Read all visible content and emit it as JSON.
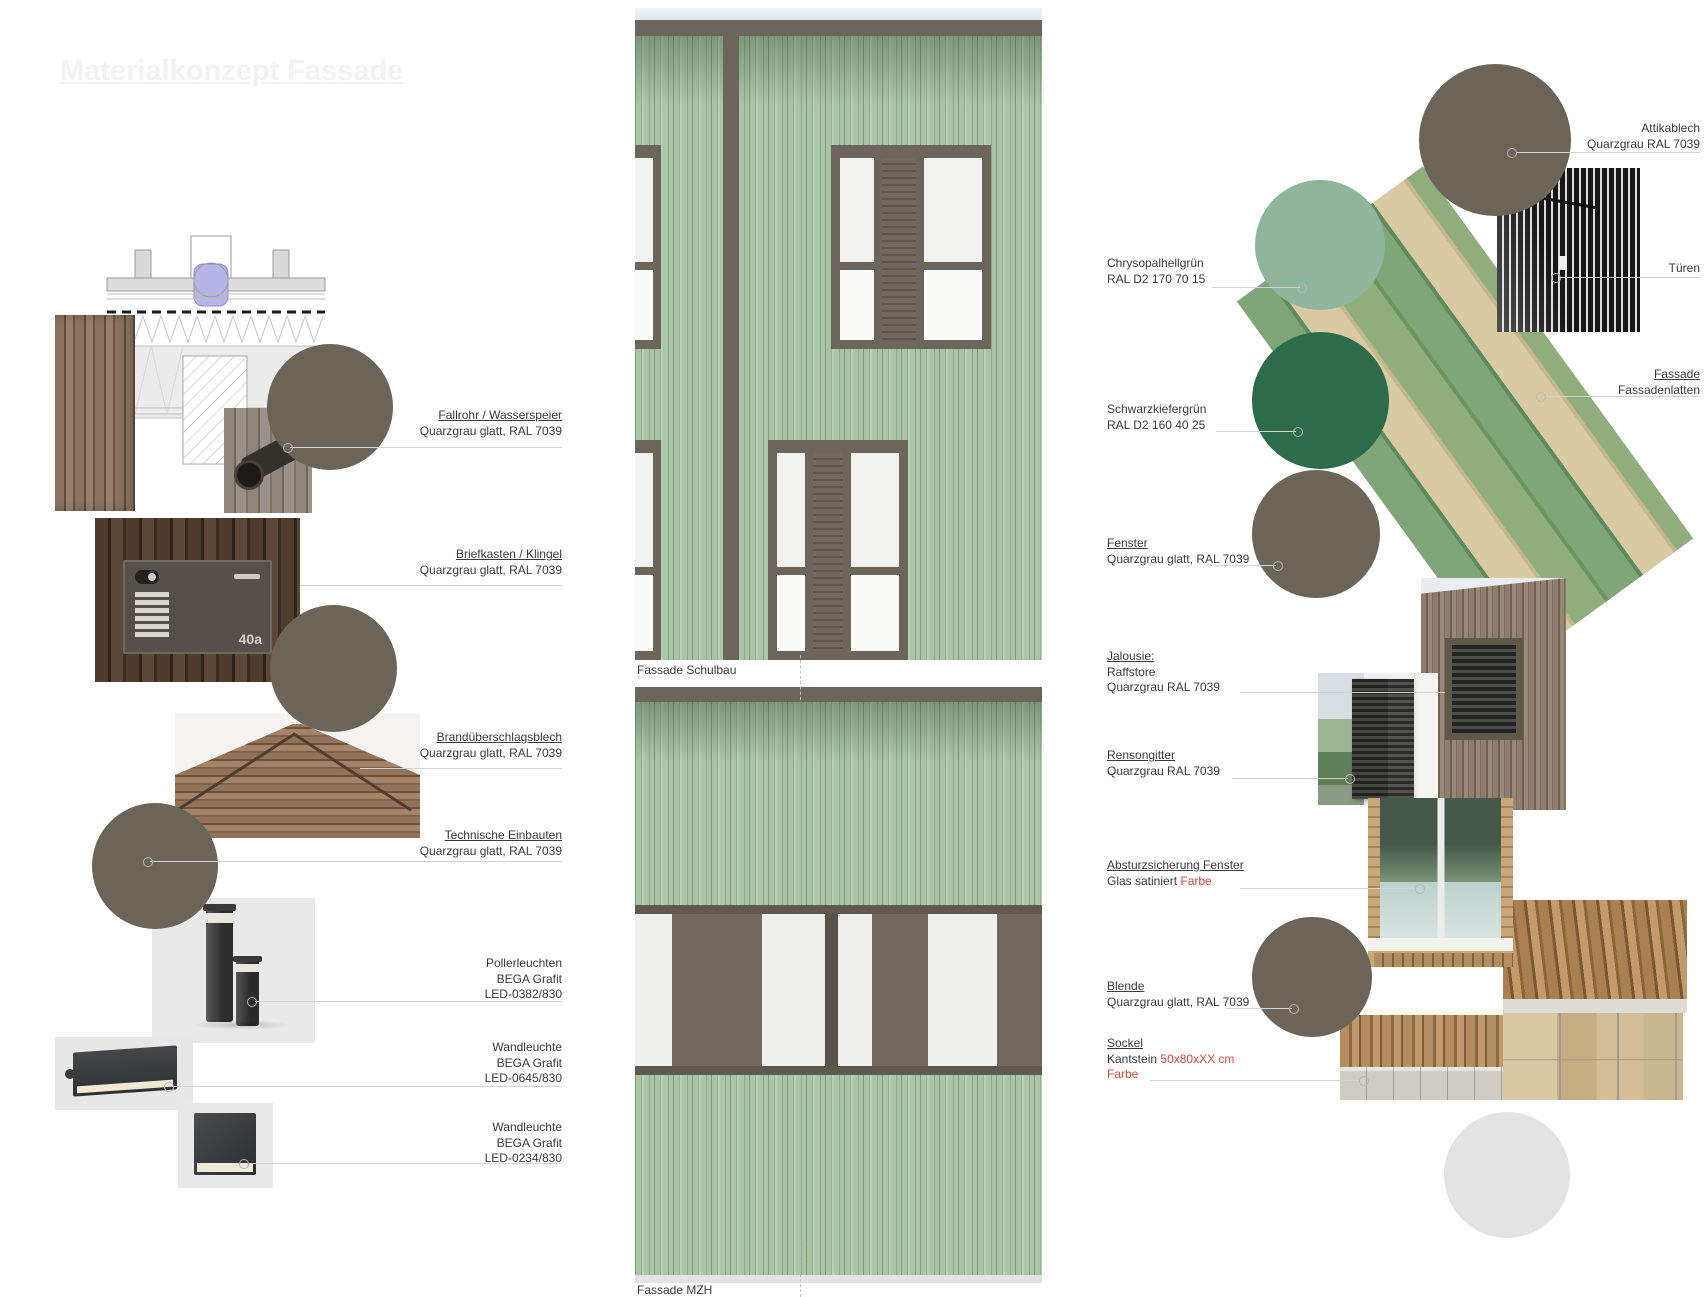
{
  "title": "Materialkonzept Fassade",
  "captions": {
    "schulbau": "Fassade Schulbau",
    "mzh": "Fassade MZH"
  },
  "mailbox_number": "40a",
  "colors": {
    "quarzgrau": "#6B6459",
    "chrysopalhellgruen": "#8FB59D",
    "schwarzkiefergruen": "#2E6B4B",
    "sockel_hell": "#E3E3E3",
    "fassade_gruen": "#A9C5A5",
    "rahmen_grau": "#6B655C",
    "akzent_rot": "#D8463C"
  },
  "left": {
    "labels": [
      {
        "title": "Fallrohr / Wasserspeier",
        "sub1": "Quarzgrau glatt, RAL 7039"
      },
      {
        "title": "Briefkasten / Klingel",
        "sub1": "Quarzgrau glatt, RAL 7039"
      },
      {
        "title": "Brandüberschlagsblech",
        "sub1": "Quarzgrau glatt, RAL 7039"
      },
      {
        "title": "Technische Einbauten",
        "sub1": "Quarzgrau glatt, RAL 7039"
      },
      {
        "title": "Pollerleuchten",
        "sub1": "BEGA Grafit",
        "sub2": "LED-0382/830"
      },
      {
        "title": "Wandleuchte",
        "sub1": "BEGA Grafit",
        "sub2": "LED-0645/830"
      },
      {
        "title": "Wandleuchte",
        "sub1": "BEGA Grafit",
        "sub2": "LED-0234/830"
      }
    ]
  },
  "right": {
    "labels_left": [
      {
        "title": "Chrysopalhellgrün",
        "sub1": "RAL D2 170 70 15"
      },
      {
        "title": "Schwarzkiefergrün",
        "sub1": "RAL D2 160 40 25"
      },
      {
        "title": "Fenster",
        "sub1": "Quarzgrau glatt, RAL 7039"
      },
      {
        "title": "Jalousie:",
        "sub1": "Raffstore",
        "sub2": "Quarzgrau RAL 7039"
      },
      {
        "title": "Rensongitter",
        "sub1": "Quarzgrau RAL 7039"
      },
      {
        "title": "Absturzsicherung Fenster",
        "sub1_black": "Glas satiniert",
        "sub1_red": "Farbe"
      },
      {
        "title": "Blende",
        "sub1": "Quarzgrau glatt, RAL 7039"
      },
      {
        "title": "Sockel",
        "sub1_black": "Kantstein",
        "sub1_red": "50x80xXX cm",
        "sub2_red": "Farbe"
      }
    ],
    "labels_right": [
      {
        "title": "Attikablech",
        "sub1": "Quarzgrau RAL 7039"
      },
      {
        "title": "Türen"
      },
      {
        "title": "Fassade",
        "sub1": "Fassadenlatten"
      }
    ]
  }
}
